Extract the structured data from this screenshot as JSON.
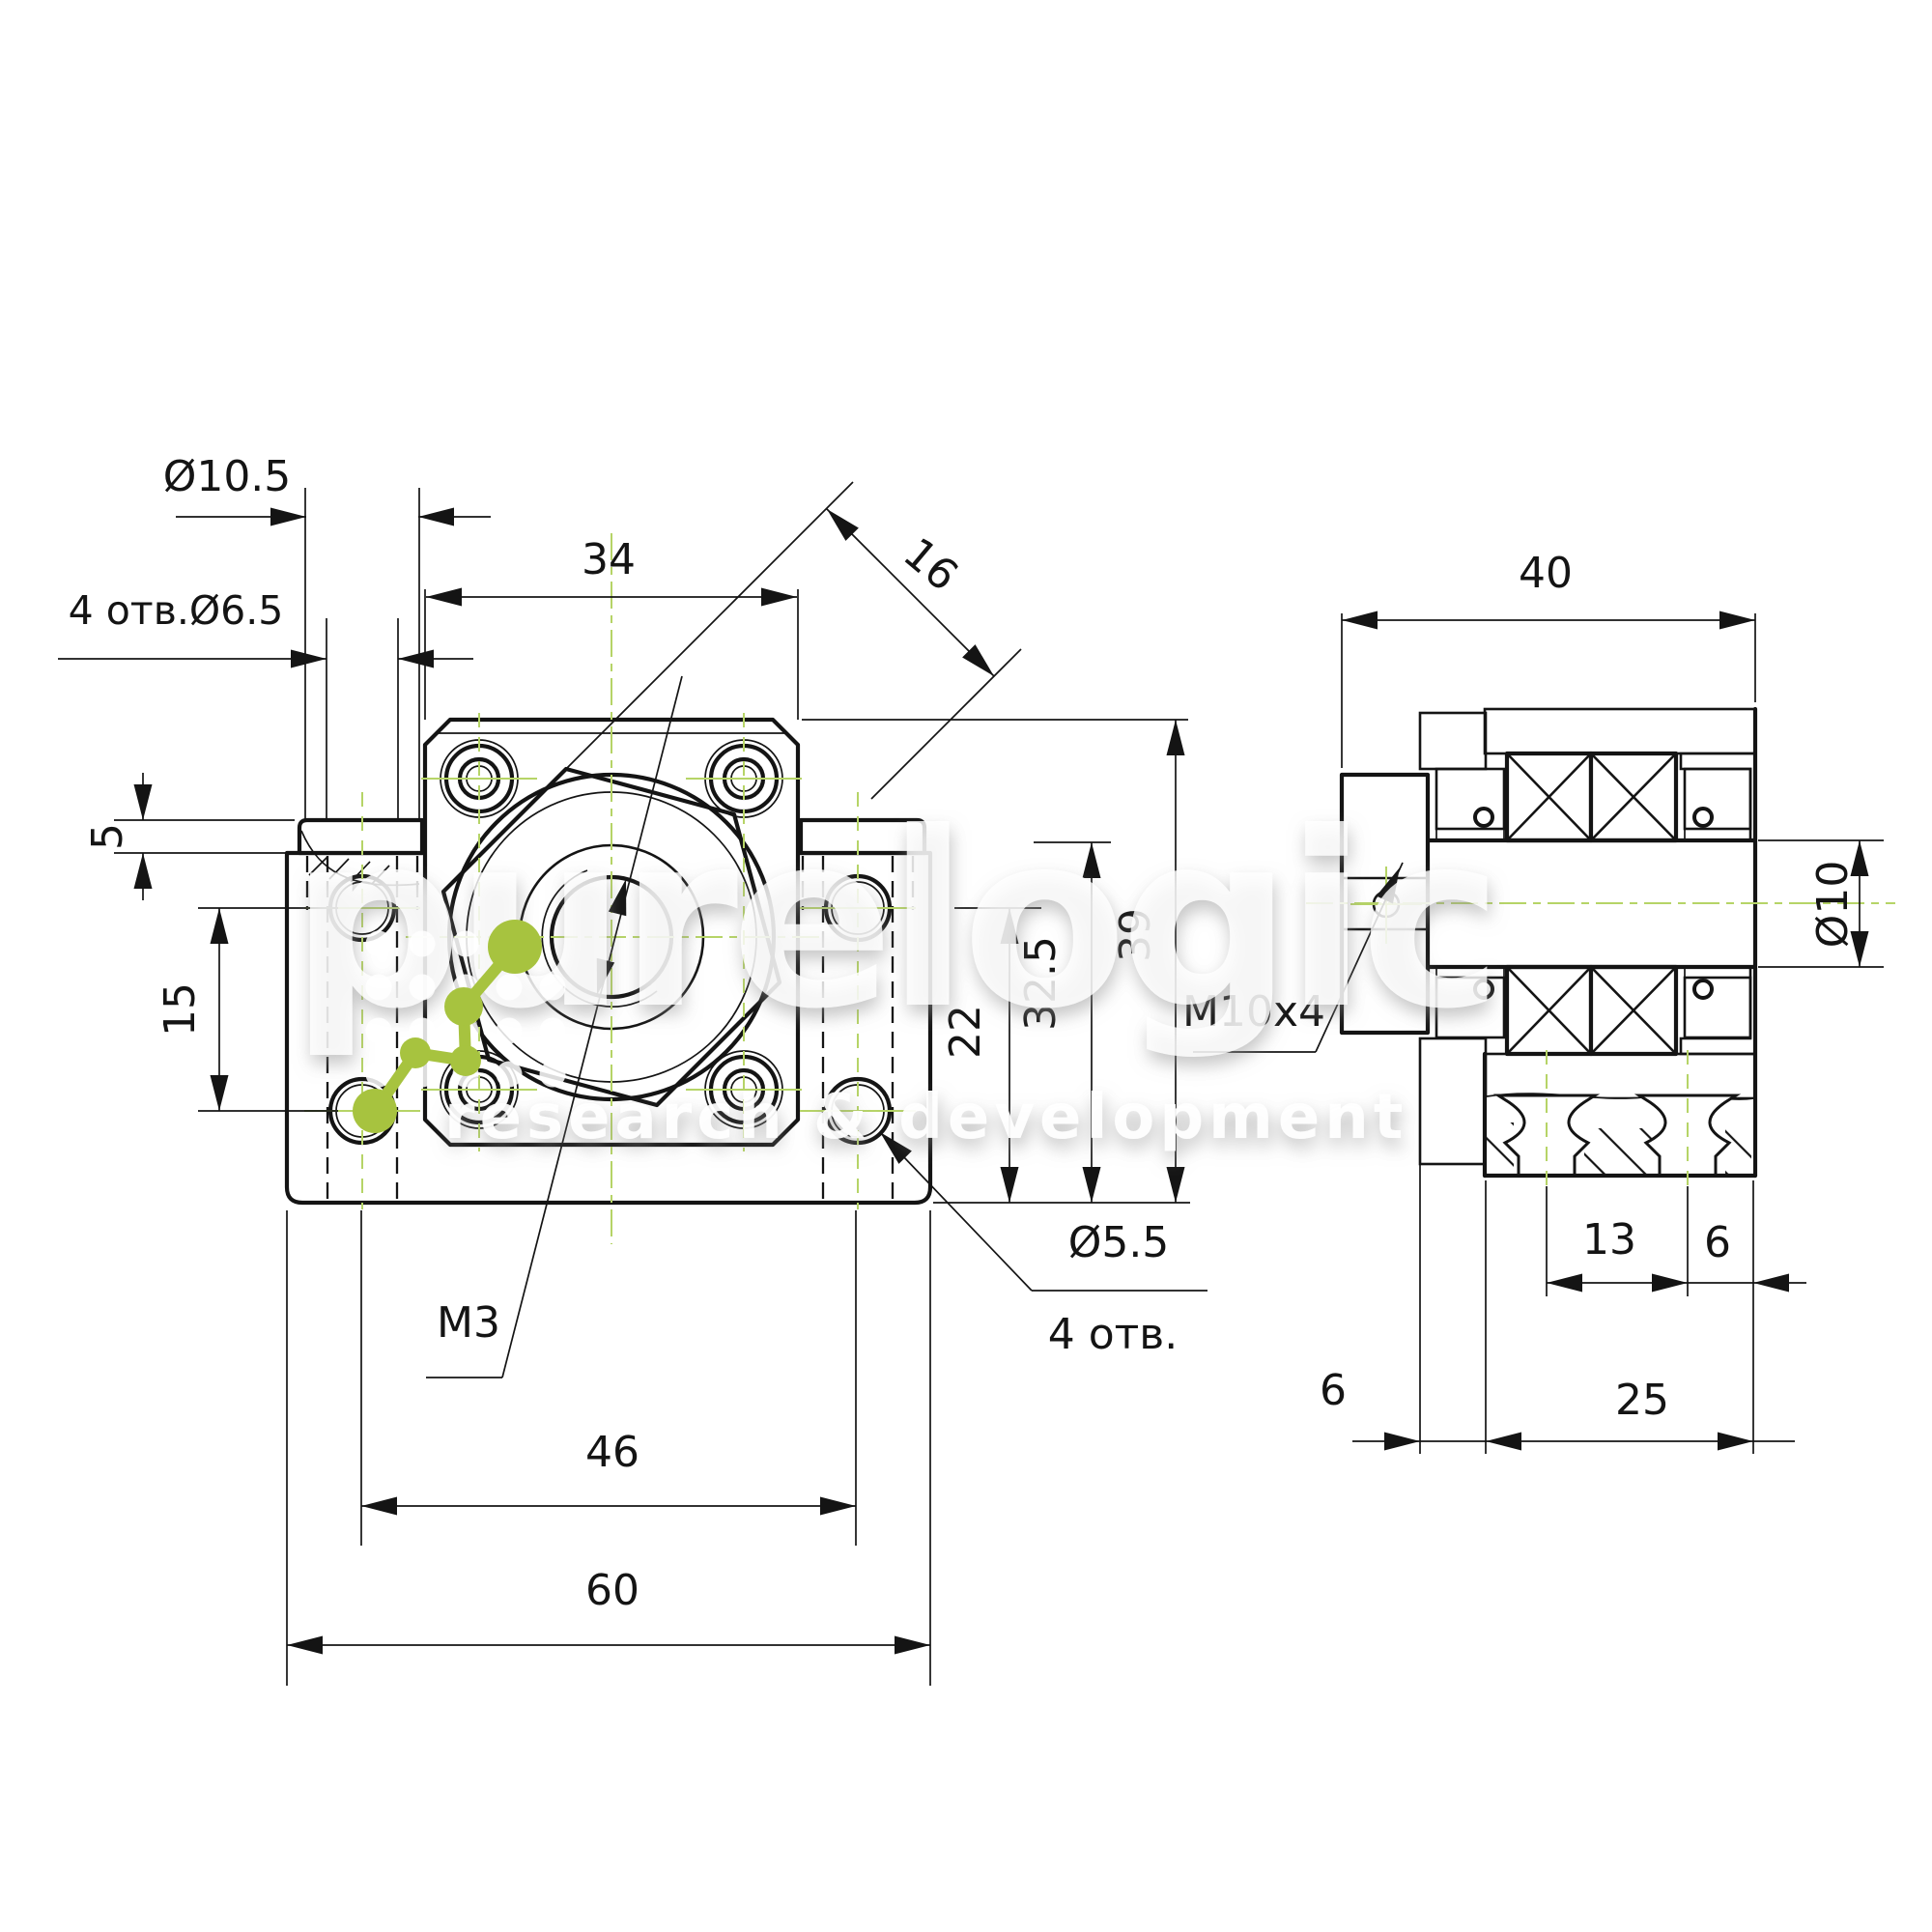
{
  "watermark": {
    "brand": "purelogic",
    "tagline": "research & development",
    "logo_color": "#a7c33f",
    "dot_color": "#ffffff"
  },
  "colors": {
    "line": "#141414",
    "centerline_green": "#b6d467",
    "background": "#ffffff"
  },
  "front_view": {
    "labels": {
      "counterbore_dia": "Ø10.5",
      "base_holes": "4 отв.Ø6.5",
      "flange_width": "34",
      "hex_flat": "16",
      "step_height": "5",
      "base_hole_spacing_v": "15",
      "thread": "M3",
      "hole_spacing_h": "46",
      "base_width": "60",
      "corner_hole_dia": "Ø5.5",
      "corner_hole_count": "4 отв.",
      "center_height": "22",
      "mid_height": "32.5",
      "total_height": "39"
    }
  },
  "side_view": {
    "labels": {
      "depth_total": "40",
      "shaft_bore": "Ø10",
      "lube_thread": "M10x4",
      "hole_pitch": "13",
      "edge_offset_right": "6",
      "body_depth": "25",
      "flange_lip": "6"
    }
  }
}
